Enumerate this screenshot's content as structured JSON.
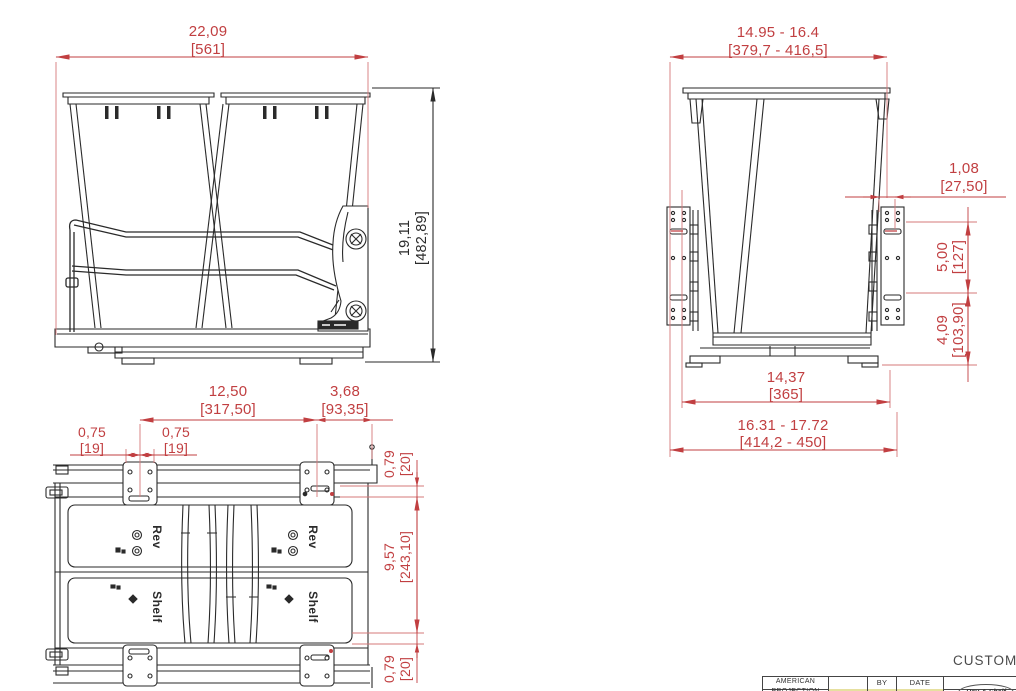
{
  "colors": {
    "dimension_red": "#c13f41",
    "extension_pink": "#d4787a",
    "ink": "#2a2a2a",
    "highlight": "#e6e09f"
  },
  "front_view": {
    "width_in": "22,09",
    "width_mm": "[561]",
    "height_in": "19,11",
    "height_mm": "[482,89]"
  },
  "side_view": {
    "top_width_in": "14.95 - 16.4",
    "top_width_mm": "[379,7 - 416,5]",
    "offset_in": "1,08",
    "offset_mm": "[27,50]",
    "upper_height_in": "5,00",
    "upper_height_mm": "[127]",
    "lower_height_in": "4,09",
    "lower_height_mm": "[103,90]",
    "base_width_in": "14,37",
    "base_width_mm": "[365]",
    "overall_width_in": "16.31 - 17.72",
    "overall_width_mm": "[414,2 - 450]"
  },
  "plan_view": {
    "slide_span_in": "12,50",
    "slide_span_mm": "[317,50]",
    "rear_offset_in": "3,68",
    "rear_offset_mm": "[93,35]",
    "bracket_left_in": "0,75",
    "bracket_left_mm": "[19]",
    "bracket_right_in": "0,75",
    "bracket_right_mm": "[19]",
    "edge_top_in": "0,79",
    "edge_top_mm": "[20]",
    "depth_in": "9,57",
    "depth_mm": "[243,10]",
    "edge_bottom_in": "0,79",
    "edge_bottom_mm": "[20]",
    "brand_top": "Rev",
    "brand_bottom": "Shelf"
  },
  "title_block": {
    "customer_label": "CUSTOME",
    "projection_line1": "AMERICAN",
    "projection_line2": "PROJECTION",
    "by_label": "BY",
    "date_label": "DATE",
    "logo_text": "Rev-A-Shelf"
  }
}
